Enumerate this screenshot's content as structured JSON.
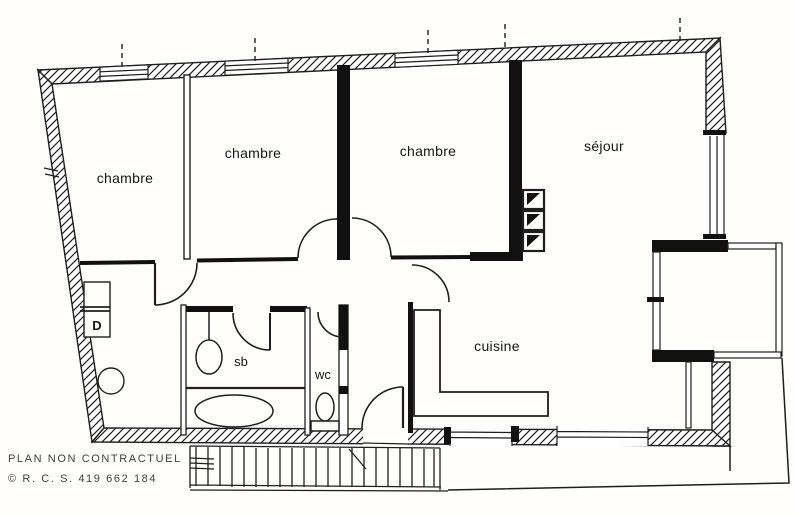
{
  "plan": {
    "kind": "apartment-floor-plan",
    "colors": {
      "ink": "#1e1e1e",
      "wall_fill": "#111111",
      "paper": "#fffefb",
      "footer_text": "#3f3f3f"
    },
    "rooms": {
      "chambre_left": {
        "label": "chambre"
      },
      "chambre_middle": {
        "label": "chambre"
      },
      "chambre_right": {
        "label": "chambre"
      },
      "sejour": {
        "label": "séjour"
      },
      "cuisine": {
        "label": "cuisine"
      },
      "salle_de_bain": {
        "label": "sb"
      },
      "wc": {
        "label": "wc"
      },
      "closet": {
        "label": "D"
      }
    },
    "footer": {
      "line1": "PLAN NON CONTRACTUEL",
      "line2": "© R. C. S. 419 662 184"
    }
  }
}
